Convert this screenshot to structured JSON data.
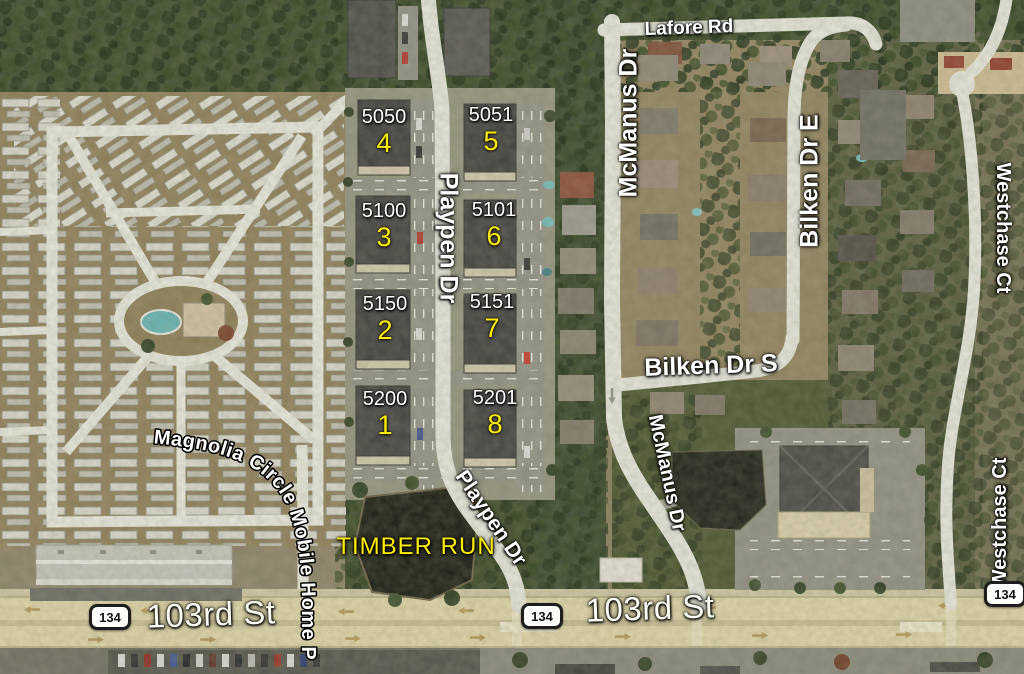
{
  "map": {
    "street_labels": [
      {
        "id": "lafore-rd",
        "text": "Lafore Rd"
      },
      {
        "id": "mcmanus-dr-north",
        "text": "McManus Dr"
      },
      {
        "id": "bilken-dr-e",
        "text": "Bilken Dr E"
      },
      {
        "id": "westchase-ct-north",
        "text": "Westchase Ct"
      },
      {
        "id": "bilken-dr-s",
        "text": "Bilken Dr S"
      },
      {
        "id": "mcmanus-dr-south",
        "text": "McManus Dr"
      },
      {
        "id": "westchase-ct-south",
        "text": "Westchase Ct"
      },
      {
        "id": "playpen-dr-north",
        "text": "Playpen Dr"
      },
      {
        "id": "playpen-dr-south",
        "text": "Playpen Dr"
      },
      {
        "id": "103rd-st-west",
        "text": "103rd St"
      },
      {
        "id": "103rd-st-east",
        "text": "103rd St"
      },
      {
        "id": "magnolia-circle",
        "text": "Magnolia Circle Mobile Home Park"
      }
    ],
    "poi_labels": [
      {
        "id": "timber-run",
        "text": "TIMBER RUN"
      }
    ],
    "route_shields": [
      {
        "route": "134"
      },
      {
        "route": "134"
      },
      {
        "route": "134"
      }
    ],
    "buildings": [
      {
        "address": "5050",
        "unit": "4"
      },
      {
        "address": "5051",
        "unit": "5"
      },
      {
        "address": "5100",
        "unit": "3"
      },
      {
        "address": "5101",
        "unit": "6"
      },
      {
        "address": "5150",
        "unit": "2"
      },
      {
        "address": "5151",
        "unit": "7"
      },
      {
        "address": "5200",
        "unit": "1"
      },
      {
        "address": "5201",
        "unit": "8"
      }
    ],
    "colors": {
      "label_white": "#ffffff",
      "label_yellow": "#ffee00",
      "road_major": "#ddd2a6",
      "road_minor": "#e6e5dd",
      "forest": "#2c3a21",
      "pond": "#15170f"
    }
  }
}
